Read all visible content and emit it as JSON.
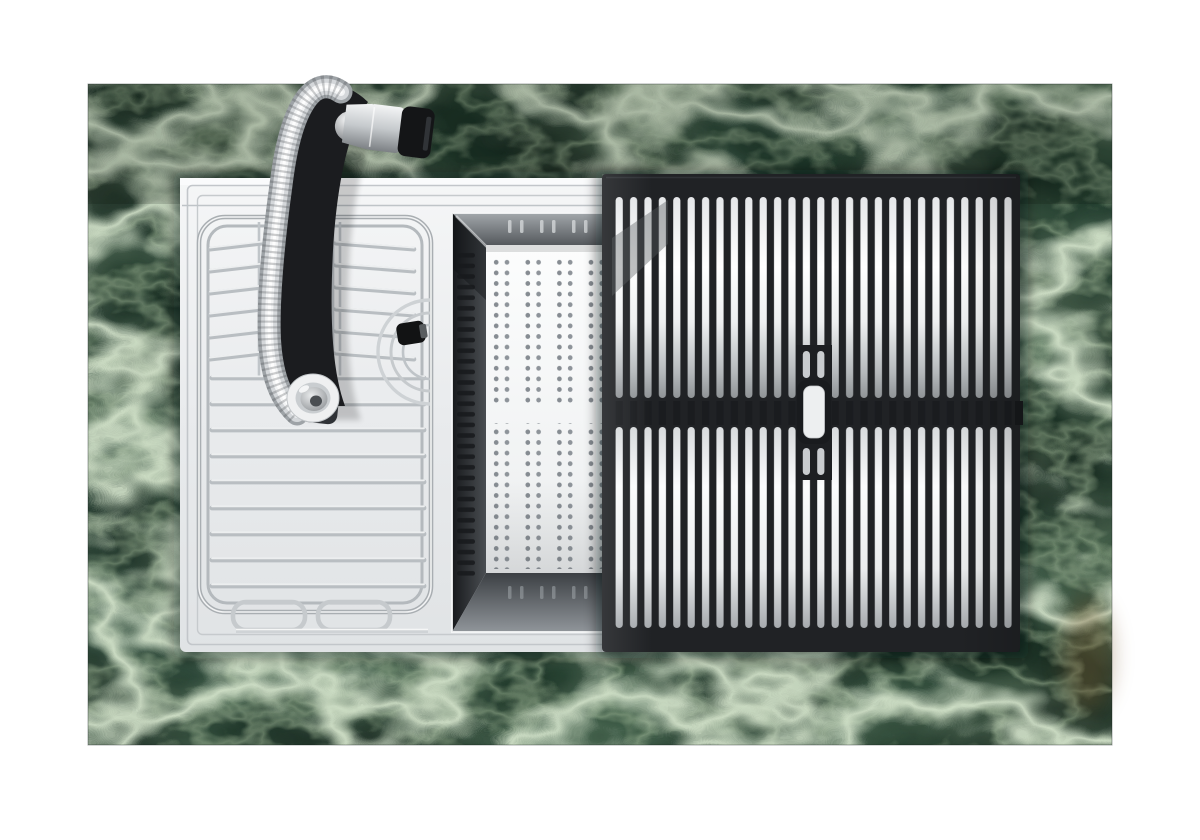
{
  "scene": {
    "kind": "product-photograph",
    "subject": "workstation-kitchen-sink-top-view",
    "background_color": "#ffffff"
  },
  "countertop": {
    "name": "green-marble-countertop",
    "base_color": "#23402f",
    "dark_tone": "#14241a",
    "vein_color": "#d8e7cf",
    "fine_vein_color": "#aec6a2",
    "rust_accent_color": "#7d5c33"
  },
  "sink": {
    "name": "stainless-steel-sink",
    "deck_color": "#eef0f1",
    "groove_color": "#bfc4c8",
    "well_color": "#2c2f33"
  },
  "accessories": {
    "wire_rack": {
      "name": "chrome-wire-dish-rack",
      "wire_color": "#b9bec2",
      "highlight_color": "#f6f7f8"
    },
    "colander": {
      "name": "perforated-colander-tray",
      "tray_color": "#fbfcfc",
      "hole_color": "#868c92"
    },
    "rollup_rack": {
      "name": "black-rollup-drying-rack",
      "slat_color": "#202225",
      "slot_color": "#eef0f1",
      "handle_tab_color": "#edeff0"
    },
    "drain": {
      "name": "drain-strainer",
      "ring_color": "#ced2d5",
      "knob_color": "#121314"
    }
  },
  "faucet": {
    "name": "pull-down-faucet",
    "body_color": "#1b1c1f",
    "hose_color": "#d4d7da",
    "handle_chrome_color": "#e8eaec",
    "handle_cap_color": "#141517",
    "spout_ring_color": "#eff0f1"
  }
}
